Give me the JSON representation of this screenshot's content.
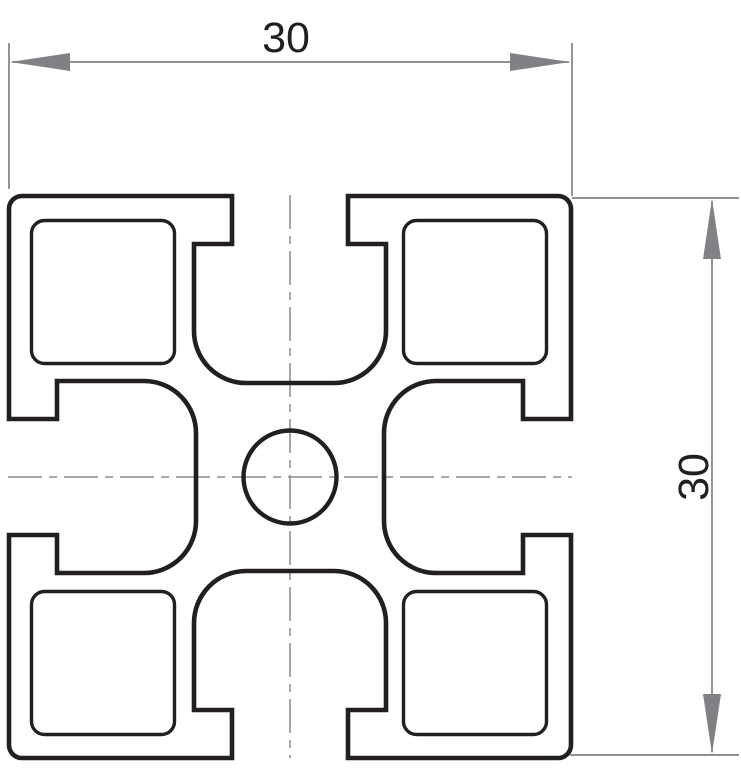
{
  "dimensions": {
    "horizontal": {
      "label": "30"
    },
    "vertical": {
      "label": "30"
    }
  },
  "colors": {
    "outline": "#231f20",
    "dimension": "#808184",
    "centerline": "#9b9c9f",
    "background": "#ffffff",
    "label_text": "#231f20"
  }
}
